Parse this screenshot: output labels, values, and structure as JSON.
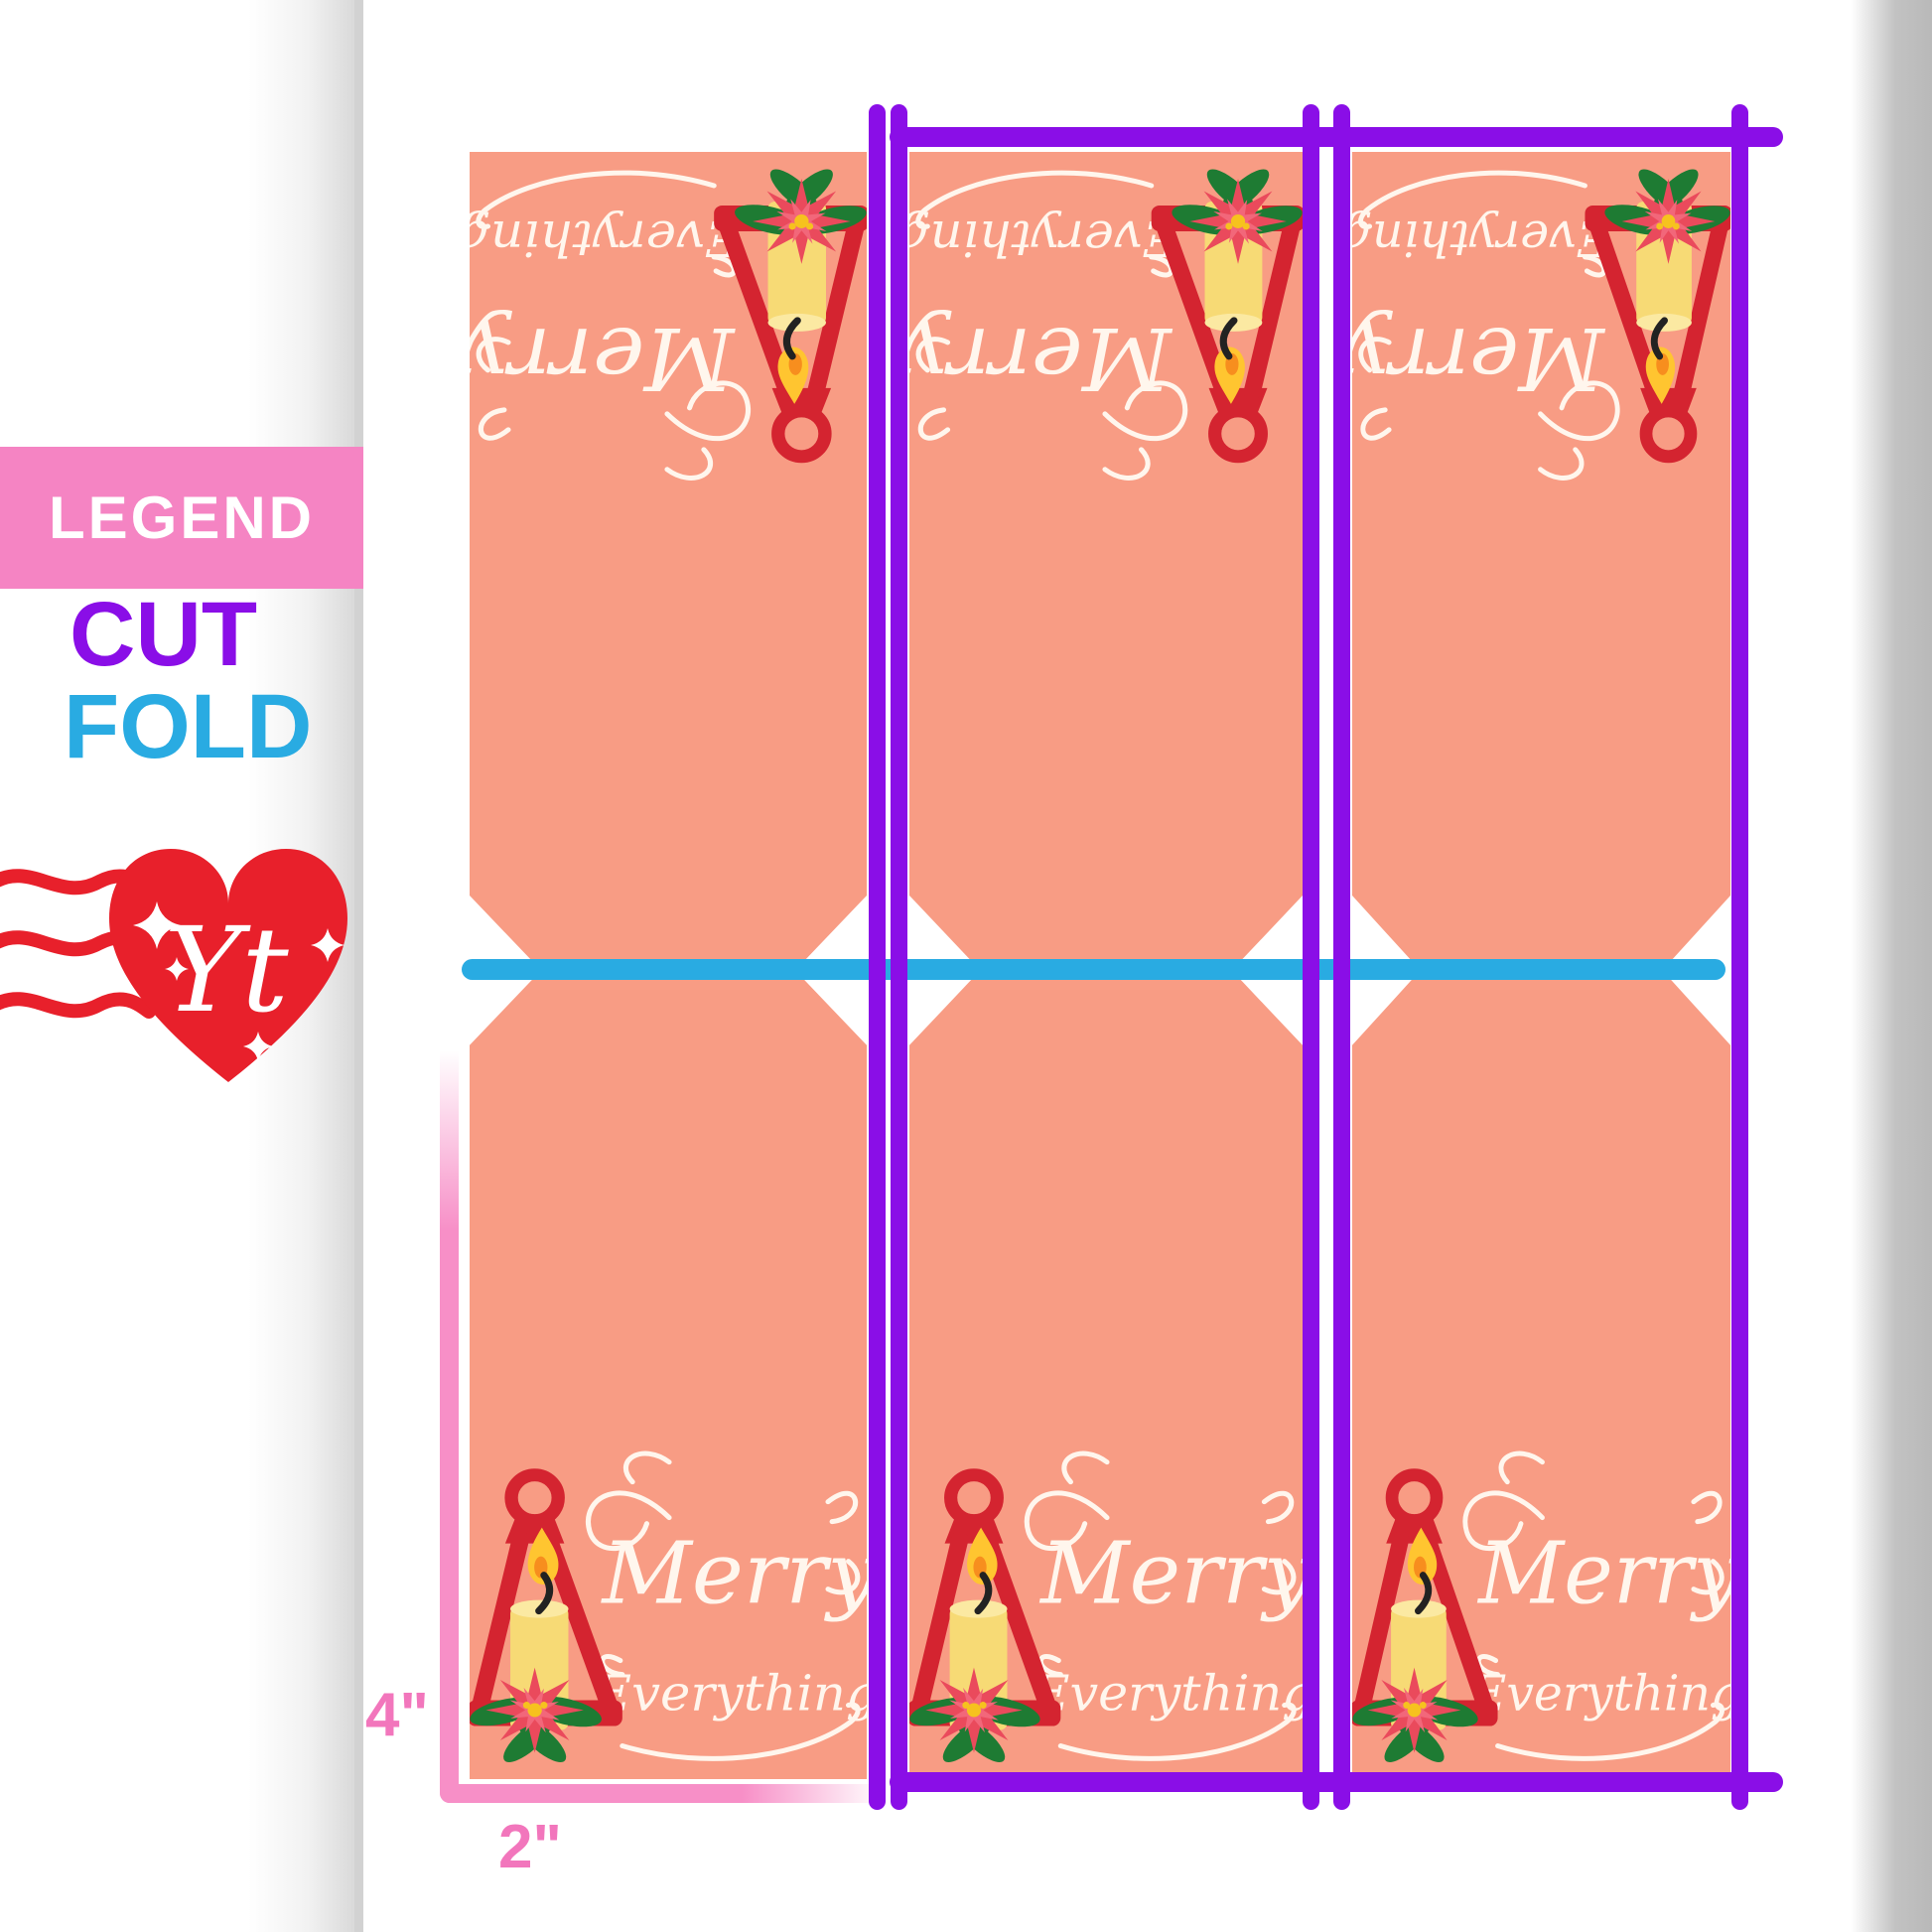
{
  "legend": {
    "title": "LEGEND",
    "cut_label": "CUT",
    "fold_label": "FOLD"
  },
  "logo": {
    "monogram": "Yt"
  },
  "dimensions": {
    "height_label": "4\"",
    "width_label": "2\""
  },
  "card": {
    "count": 3,
    "greeting_line1": "Merry",
    "greeting_line2": "Everything"
  },
  "colors": {
    "cut_purple": "#8A0EE7",
    "fold_cyan": "#29ABE2",
    "card_salmon": "#F89C84",
    "legend_pink": "#F584C3",
    "dimension_pink": "#F276BC",
    "logo_red": "#E8202B",
    "lantern_red": "#D42430",
    "candle_yellow": "#F7DA75",
    "poinsettia_red": "#EA4A5C",
    "leaf_green": "#1E7B33",
    "script_cream": "#FFF6ED"
  }
}
